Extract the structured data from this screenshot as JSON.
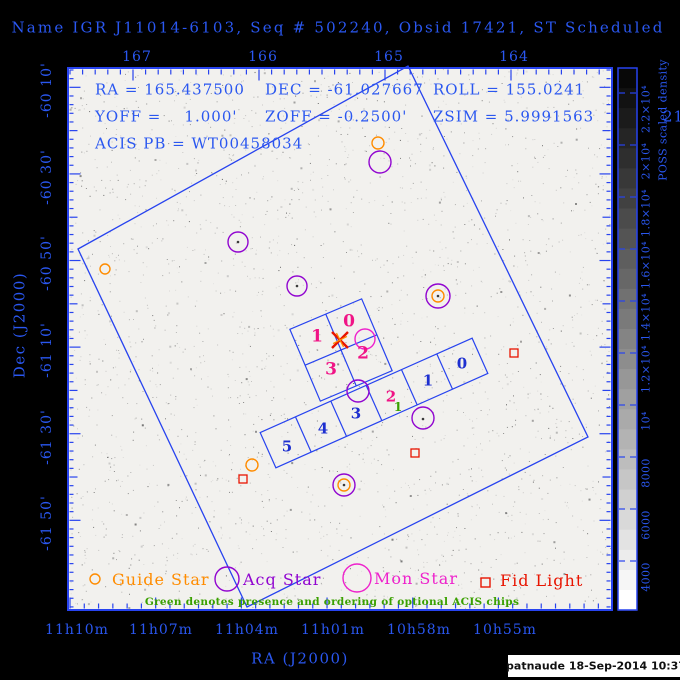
{
  "header": {
    "title": "Name IGR J11014-6103, Seq # 502240, Obsid 17421, ST Scheduled"
  },
  "params": {
    "ra": "RA = 165.437500",
    "dec": "DEC = -61.027667",
    "roll": "ROLL = 155.0241",
    "yoff": "YOFF =    1.000'",
    "zoff": "ZOFF = -0.2500'",
    "zsim": "ZSIM = 5.9991563",
    "zsim_overflow": "21",
    "acis_pb": "ACIS PB = WT00458034"
  },
  "axes": {
    "xlabel": "RA (J2000)",
    "ylabel": "Dec (J2000)",
    "top_ticks": [
      "167",
      "166",
      "165",
      "164"
    ],
    "bottom_ticks": [
      "11h10m",
      "11h07m",
      "11h04m",
      "11h01m",
      "10h58m",
      "10h55m"
    ],
    "left_ticks": [
      "-60 10'",
      "-60 30'",
      "-60 50'",
      "-61 10'",
      "-61 30'",
      "-61 50'"
    ]
  },
  "colorbar": {
    "label": "POSS scaled density",
    "ticks": [
      "2.2×10⁴",
      "2×10⁴",
      "1.8×10⁴",
      "1.6×10⁴",
      "1.4×10⁴",
      "1.2×10⁴",
      "10⁴",
      "8000",
      "6000",
      "4000"
    ]
  },
  "legend": {
    "guide": "Guide Star",
    "acq": "Acq Star",
    "mon": "Mon Star",
    "fid": "Fid Light",
    "note": "Green denotes presence and ordering of optional ACIS chips"
  },
  "credit": "patnaude 18-Sep-2014 10:37",
  "colors": {
    "frame": "#2743ef",
    "text_blue": "#2a57f0",
    "chip_blue": "#1d2fd0",
    "pink": "#f01486",
    "green": "#3aa000",
    "orange": "#ff8c00",
    "purple": "#9105d0",
    "magenta": "#ee22cc",
    "red": "#e81400"
  },
  "chart_data": {
    "type": "scatter",
    "title": "Name IGR J11014-6103, Seq # 502240, Obsid 17421, ST Scheduled",
    "projection": "sky RA/Dec with POSS background image",
    "x_axis": {
      "label": "RA (J2000)",
      "top_edge_ticks_deg": [
        167,
        166,
        165,
        164
      ],
      "bottom_edge_ticks": [
        "11h10m",
        "11h07m",
        "11h04m",
        "11h01m",
        "10h58m",
        "10h55m"
      ]
    },
    "y_axis": {
      "label": "Dec (J2000)",
      "ticks": [
        "-60 10'",
        "-60 30'",
        "-60 50'",
        "-61 10'",
        "-61 30'",
        "-61 50'"
      ]
    },
    "colorbar": {
      "label": "POSS scaled density",
      "range": [
        4000,
        22000
      ],
      "tick_step": 2000
    },
    "target": {
      "ra_deg": 165.4375,
      "dec_deg": -61.027667,
      "roll_deg": 155.0241,
      "yoff_arcmin": 1.0,
      "zoff_arcmin": -0.25,
      "zsim_mm": 5.9991563
    },
    "fov_polygon_px": [
      [
        78,
        249
      ],
      [
        408,
        66
      ],
      [
        588,
        437
      ],
      [
        247,
        607
      ]
    ],
    "aimpoint_px": {
      "x": 340,
      "y": 340
    },
    "acis_i": {
      "center_px": [
        341,
        350
      ],
      "rotation_deg": -23,
      "half_size_px": 39,
      "chips": [
        {
          "label": "1",
          "x": 317,
          "y": 337
        },
        {
          "label": "0",
          "x": 349,
          "y": 322
        },
        {
          "label": "2",
          "x": 363,
          "y": 354
        },
        {
          "label": "3",
          "x": 331,
          "y": 370
        }
      ]
    },
    "acis_s": {
      "center_px": [
        374,
        403
      ],
      "rotation_deg": -24,
      "half_length_px": 116,
      "half_height_px": 19.3,
      "chips": [
        {
          "label": "5",
          "x": 287,
          "y": 447,
          "on": false
        },
        {
          "label": "4",
          "x": 323,
          "y": 429,
          "on": false
        },
        {
          "label": "3",
          "x": 356,
          "y": 414,
          "on": false
        },
        {
          "label": "2",
          "x": 391,
          "y": 397,
          "on": true
        },
        {
          "label": "1",
          "x": 428,
          "y": 381,
          "on": false
        },
        {
          "label": "0",
          "x": 462,
          "y": 364,
          "on": false
        }
      ],
      "optional_order": {
        "label": "1",
        "x": 398,
        "y": 407
      }
    },
    "markers": {
      "guide_stars": [
        [
          105,
          269,
          5
        ],
        [
          378,
          143,
          6
        ],
        [
          438,
          296,
          6
        ],
        [
          252,
          465,
          6
        ],
        [
          344,
          485,
          6
        ]
      ],
      "acq_stars": [
        [
          380,
          162,
          11
        ],
        [
          238,
          242,
          10
        ],
        [
          297,
          286,
          10
        ],
        [
          438,
          296,
          12
        ],
        [
          358,
          391,
          11
        ],
        [
          423,
          418,
          11
        ],
        [
          344,
          485,
          11
        ]
      ],
      "mon_stars": [
        [
          365,
          339,
          10
        ]
      ],
      "fid_lights": [
        [
          514,
          353
        ],
        [
          415,
          453
        ],
        [
          243,
          479
        ]
      ],
      "star_dots": [
        [
          238,
          242
        ],
        [
          297,
          286
        ],
        [
          438,
          296
        ],
        [
          423,
          419
        ],
        [
          344,
          485
        ]
      ]
    }
  }
}
